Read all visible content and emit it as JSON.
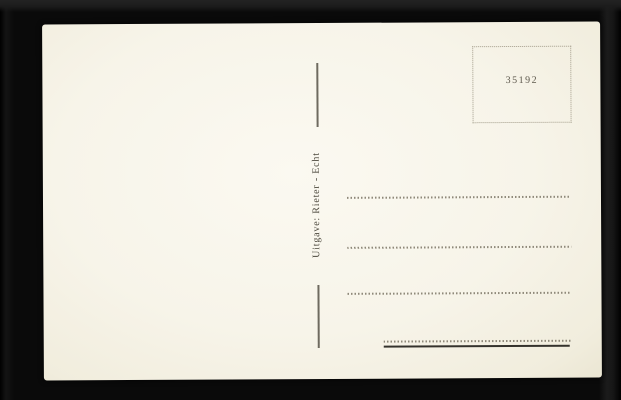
{
  "scene": {
    "description": "Back side of a blank vintage postcard photographed on a black background"
  },
  "postcard": {
    "stamp_box": {
      "number": "35192"
    },
    "publisher_line": "Uitgave: Rieter - Echt",
    "address_section": {
      "dotted_line_count": 4,
      "has_bottom_solid_rule": true
    }
  },
  "colors": {
    "background": "#0a0a0a",
    "card": "#f7f4e9",
    "ink": "#4a463b",
    "stamp_number_ink": "#5d584c",
    "dotted_line": "#8f897a",
    "divider_line": "#6e6a5f",
    "solid_rule": "#34322c"
  }
}
